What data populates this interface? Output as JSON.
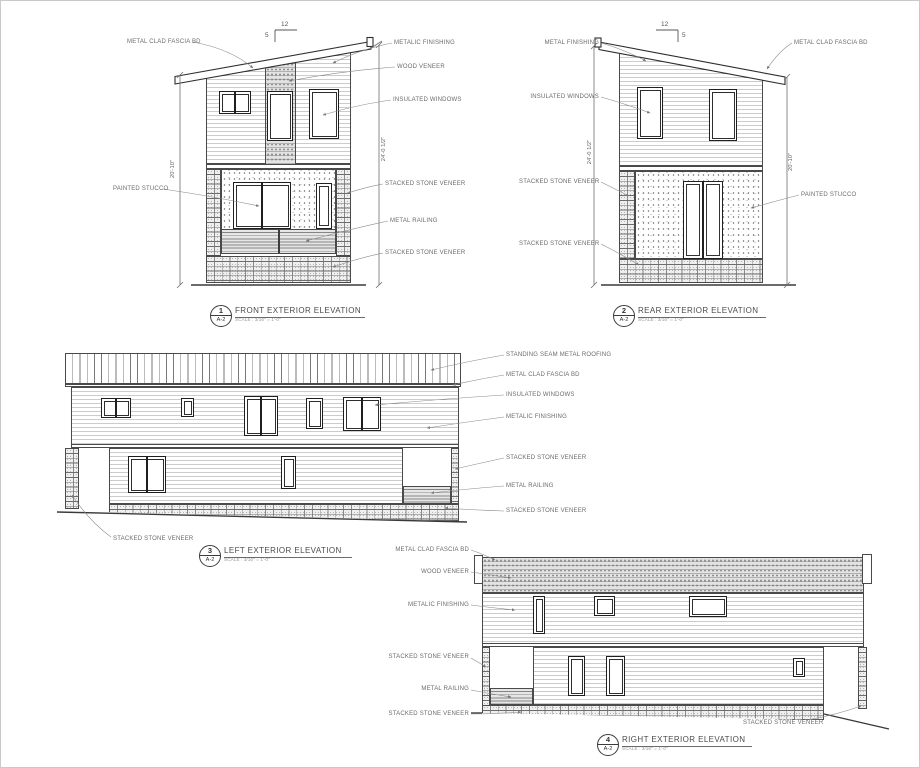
{
  "colors": {
    "line": "#3a3a3a",
    "label": "#6b6b6b",
    "paper": "#ffffff"
  },
  "sheet": {
    "titles": [
      {
        "num": "1",
        "sheet": "A-2",
        "name": "FRONT EXTERIOR ELEVATION",
        "scale": "SCALE : 3/16\" = 1'-0\""
      },
      {
        "num": "2",
        "sheet": "A-2",
        "name": "REAR EXTERIOR ELEVATION",
        "scale": "SCALE : 3/16\" = 1'-0\""
      },
      {
        "num": "3",
        "sheet": "A-2",
        "name": "LEFT EXTERIOR ELEVATION",
        "scale": "SCALE : 3/16\" = 1'-0\""
      },
      {
        "num": "4",
        "sheet": "A-2",
        "name": "RIGHT EXTERIOR ELEVATION",
        "scale": "SCALE : 3/16\" = 1'-0\""
      }
    ]
  },
  "front": {
    "labels": {
      "fascia": "METAL CLAD FASCIA BD",
      "stucco": "PAINTED STUCCO",
      "metal_finishing": "METALIC FINISHING",
      "wood_veneer": "WOOD VENEER",
      "windows": "INSULATED WINDOWS",
      "stone_upper": "STACKED STONE VENEER",
      "railing": "METAL RAILING",
      "stone_lower": "STACKED STONE VENEER"
    },
    "dims": {
      "left": "20'-10\"",
      "right": "24'-0 1/2\""
    },
    "slope": {
      "run": "12",
      "rise": "5"
    }
  },
  "rear": {
    "labels": {
      "metal_finishing": "METAL FINISHING",
      "windows": "INSULATED WINDOWS",
      "stone_upper": "STACKED STONE VENEER",
      "stone_lower": "STACKED STONE VENEER",
      "fascia": "METAL CLAD FASCIA BD",
      "stucco": "PAINTED STUCCO"
    },
    "dims": {
      "left": "24'-0 1/2\"",
      "right": "20'-10\""
    },
    "slope": {
      "run": "12",
      "rise": "5"
    }
  },
  "left": {
    "labels": {
      "roofing": "STANDING SEAM METAL ROOFING",
      "fascia": "METAL CLAD FASCIA BD",
      "windows": "INSULATED WINDOWS",
      "metal_finishing": "METALIC FINISHING",
      "stone_upper": "STACKED STONE VENEER",
      "railing": "METAL RAILING",
      "stone_base": "STACKED STONE VENEER",
      "stone_bottom": "STACKED STONE VENEER"
    }
  },
  "right": {
    "labels": {
      "fascia": "METAL CLAD FASCIA BD",
      "wood_veneer": "WOOD VENEER",
      "metal_finishing": "METALIC FINISHING",
      "stone_upper": "STACKED STONE VENEER",
      "railing": "METAL RAILING",
      "stone_lower": "STACKED STONE VENEER",
      "stone_bottom": "STACKED STONE VENEER"
    }
  }
}
